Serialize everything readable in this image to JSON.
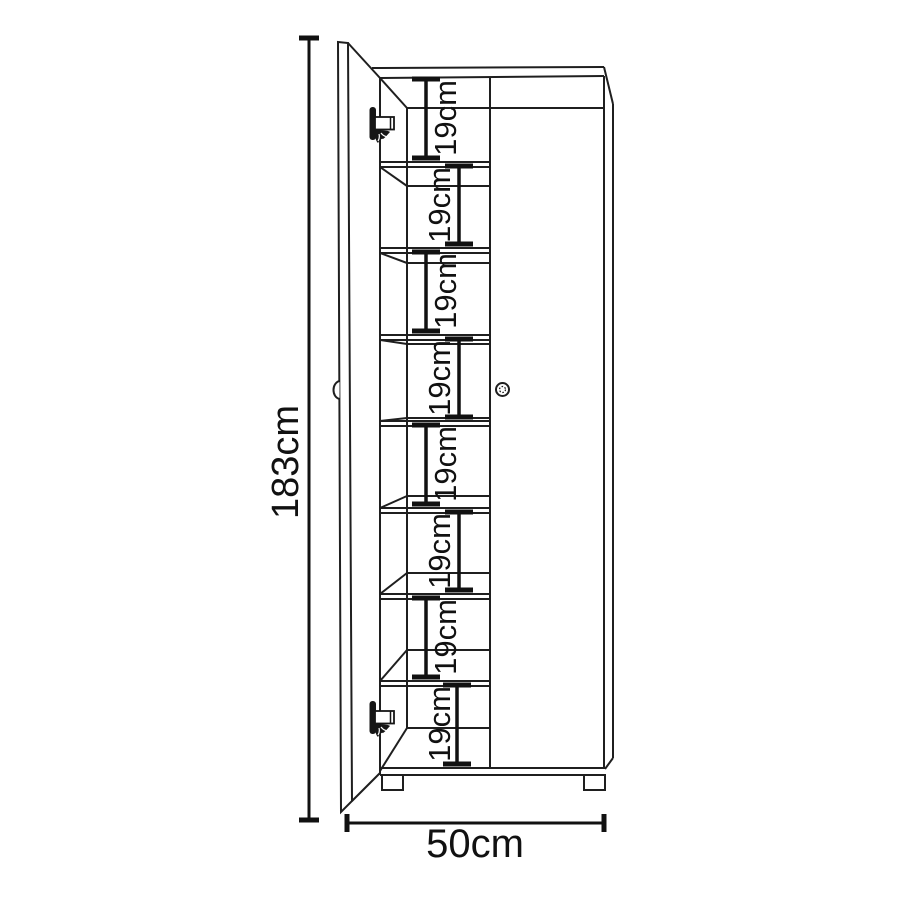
{
  "diagram": {
    "background_color": "#ffffff",
    "line_color": "#1f1f1f",
    "text_color": "#111111",
    "height_dimension": {
      "label": "183cm"
    },
    "width_dimension": {
      "label": "50cm"
    },
    "compartment_dimensions": [
      {
        "label": "19cm"
      },
      {
        "label": "19cm"
      },
      {
        "label": "19cm"
      },
      {
        "label": "19cm"
      },
      {
        "label": "19cm"
      },
      {
        "label": "19cm"
      },
      {
        "label": "19cm"
      },
      {
        "label": "19cm"
      }
    ]
  }
}
